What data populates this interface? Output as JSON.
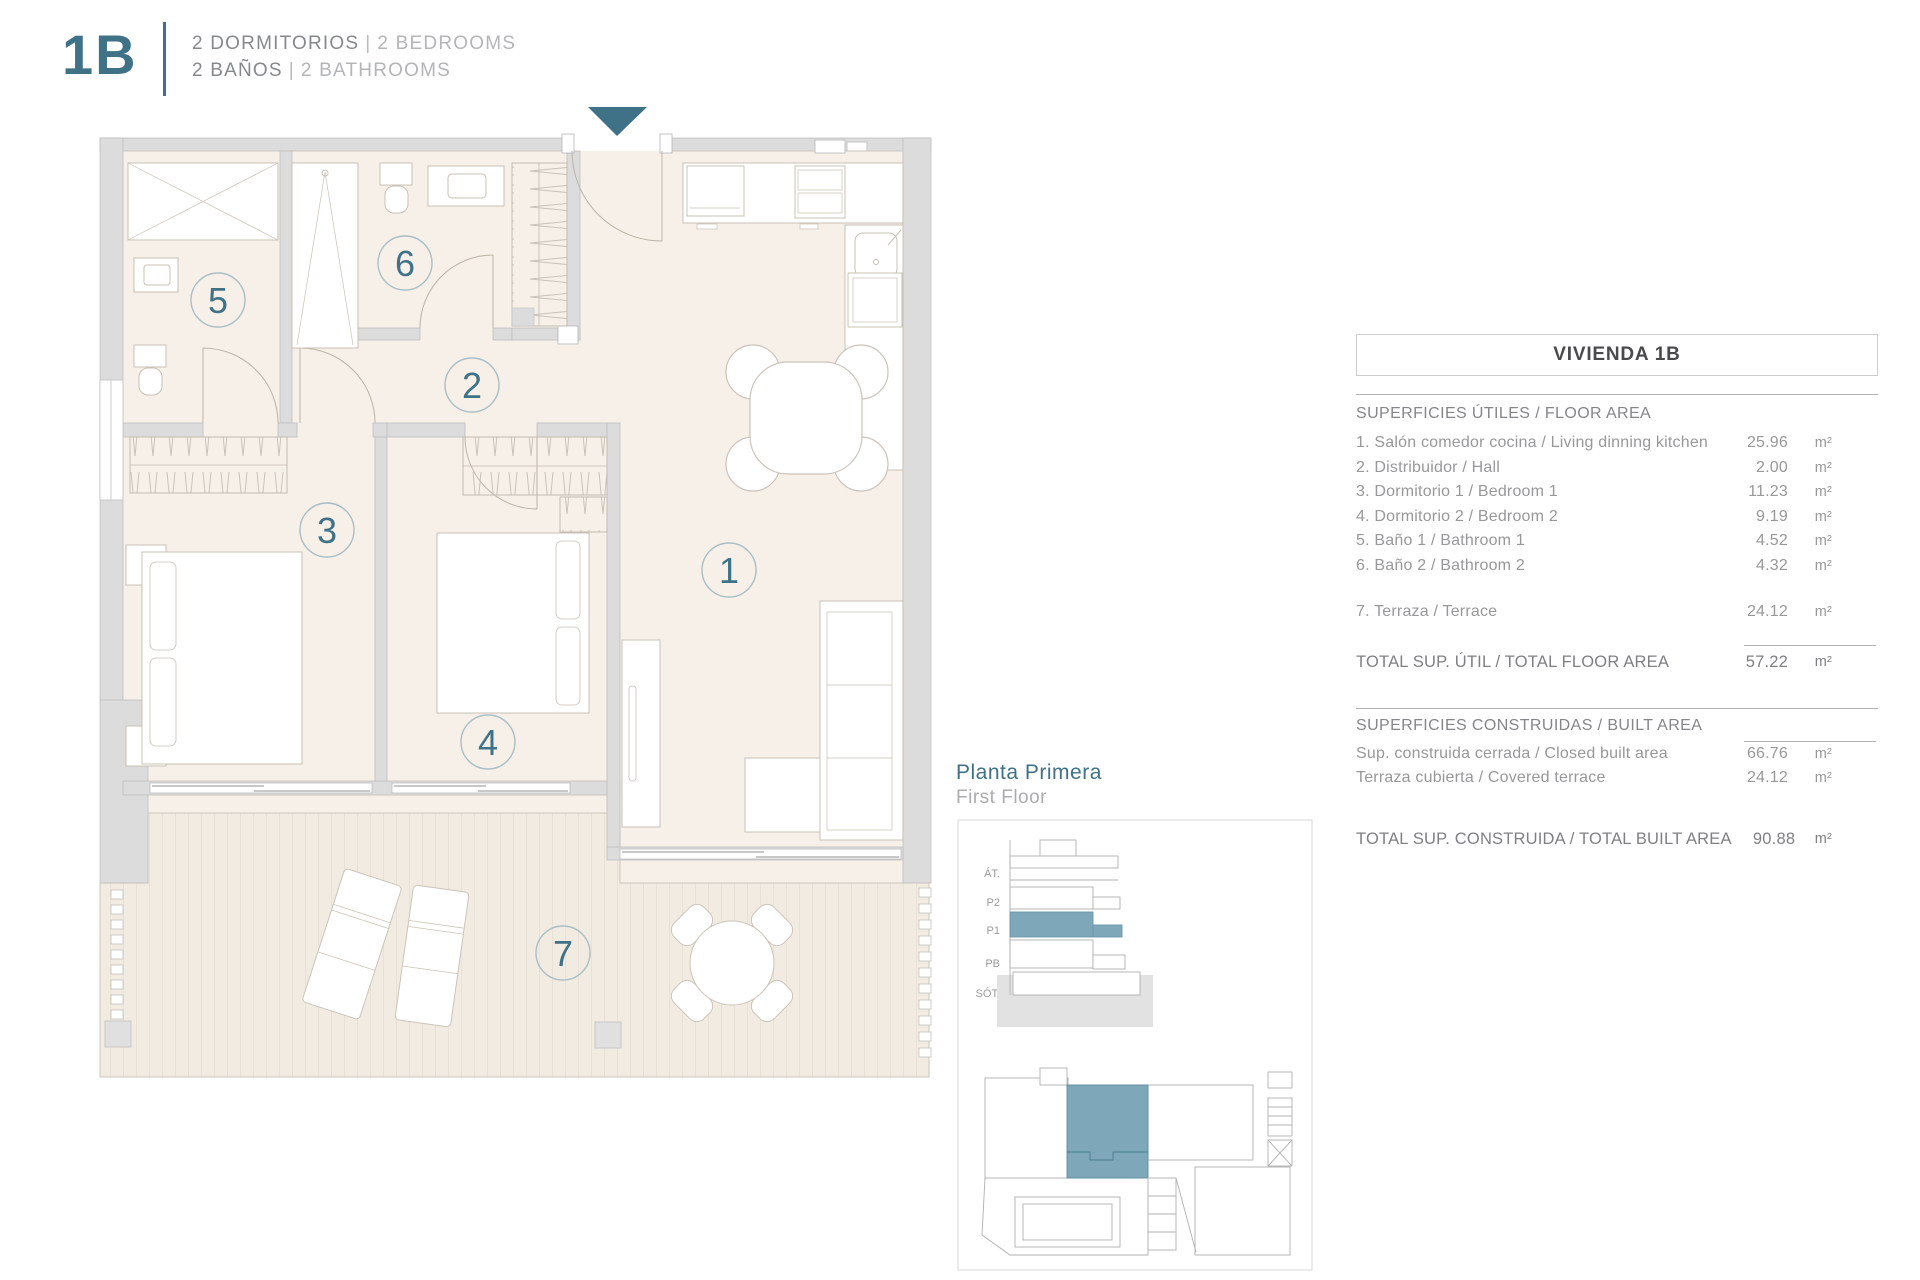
{
  "header": {
    "code": "1B",
    "line1": {
      "es": "2 DORMITORIOS",
      "sep": "|",
      "en": "2 BEDROOMS"
    },
    "line2": {
      "es": "2 BAÑOS",
      "sep": "|",
      "en": "2 BATHROOMS"
    }
  },
  "plan": {
    "room_numbers": [
      "1",
      "2",
      "3",
      "4",
      "5",
      "6",
      "7"
    ]
  },
  "key_plan": {
    "title_es": "Planta Primera",
    "title_en": "First Floor",
    "levels": [
      "ÁT.",
      "P2",
      "P1",
      "PB",
      "SÓT."
    ]
  },
  "table": {
    "title": "VIVIENDA 1B",
    "section1_header": "SUPERFICIES ÚTILES / FLOOR AREA",
    "rows1": [
      {
        "label": "1. Salón comedor cocina / Living dinning kitchen",
        "value": "25.96",
        "unit": "m²"
      },
      {
        "label": "2. Distribuidor / Hall",
        "value": "2.00",
        "unit": "m²"
      },
      {
        "label": "3. Dormitorio 1 / Bedroom 1",
        "value": "11.23",
        "unit": "m²"
      },
      {
        "label": "4. Dormitorio 2 / Bedroom 2",
        "value": "9.19",
        "unit": "m²"
      },
      {
        "label": "5. Baño 1 / Bathroom 1",
        "value": "4.52",
        "unit": "m²"
      },
      {
        "label": "6. Baño 2 / Bathroom 2",
        "value": "4.32",
        "unit": "m²"
      }
    ],
    "terrace_row": {
      "label": "7. Terraza / Terrace",
      "value": "24.12",
      "unit": "m²"
    },
    "total1": {
      "label": "TOTAL SUP. ÚTIL / TOTAL FLOOR AREA",
      "value": "57.22",
      "unit": "m²"
    },
    "section2_header": "SUPERFICIES CONSTRUIDAS / BUILT AREA",
    "rows2": [
      {
        "label": "Sup. construida cerrada / Closed built area",
        "value": "66.76",
        "unit": "m²"
      },
      {
        "label": "Terraza cubierta / Covered terrace",
        "value": "24.12",
        "unit": "m²"
      }
    ],
    "total2": {
      "label": "TOTAL SUP. CONSTRUIDA /  TOTAL BUILT AREA",
      "value": "90.88",
      "unit": "m²"
    }
  },
  "colors": {
    "accent_teal": "#3f7187",
    "unit_highlight": "#7ea8ba",
    "wall_gray": "#dcdcdc",
    "floor_cream": "#f7f0e9"
  }
}
